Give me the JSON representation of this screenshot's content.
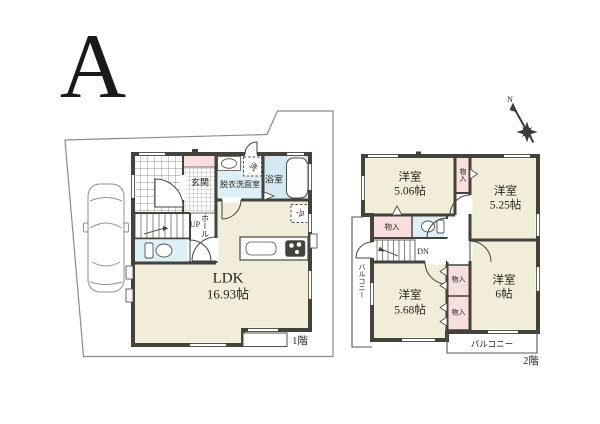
{
  "plan": {
    "variant_label": "A"
  },
  "floor1": {
    "floor_label": "1階",
    "ldk": {
      "name": "LDK",
      "area": "16.93帖"
    },
    "genkan": "玄関",
    "washroom": "脱衣洗面室",
    "bath": "浴室",
    "hall": "ホール",
    "stairs_up": "UP",
    "washer_mark": "洗",
    "fridge_mark": "冷"
  },
  "floor2": {
    "floor_label": "2階",
    "stairs_down": "DN",
    "compass_north": "N",
    "closet": "物入",
    "balcony": "バルコニー",
    "rooms": [
      {
        "name": "洋室",
        "area": "5.06帖"
      },
      {
        "name": "洋室",
        "area": "5.25帖"
      },
      {
        "name": "洋室",
        "area": "5.68帖"
      },
      {
        "name": "洋室",
        "area": "6帖"
      }
    ]
  },
  "colors": {
    "wall": "#44433b",
    "room_cream": "#f1edd8",
    "closet_pink": "#f8dede",
    "bath_blue": "#d3e9f2",
    "sanitary_blue": "#ddeff7",
    "site_line": "#8b8b8b"
  }
}
